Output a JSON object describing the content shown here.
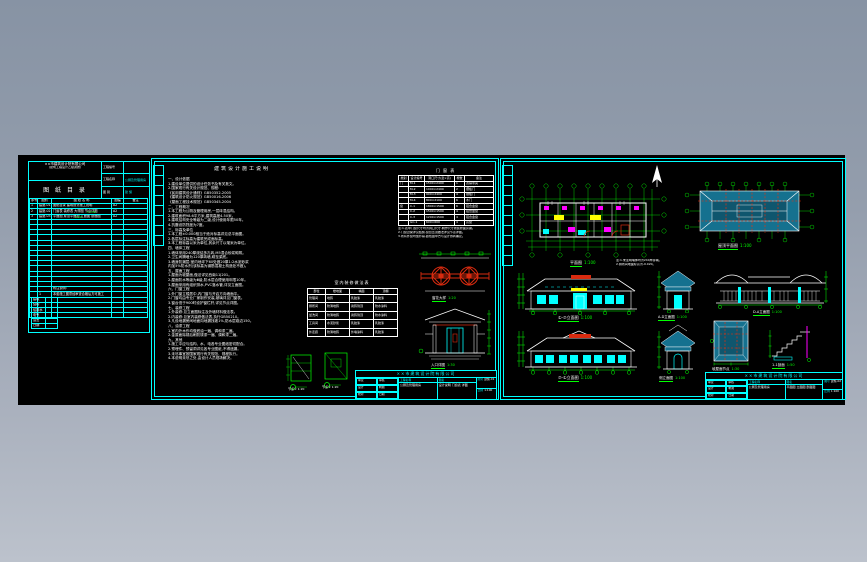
{
  "colors": {
    "cyan": "#00ffff",
    "green": "#00ff00",
    "white": "#ffffff",
    "red": "#d92b0f",
    "teal": "#15718f",
    "teal_dark": "#0f566e",
    "magenta": "#ff00ff",
    "yellow": "#ffff00",
    "canvas": "#000000"
  },
  "index_sheet": {
    "company_line1": "××市建筑设计院有限公司",
    "company_line2": "(建筑工程设计乙级资质)",
    "title": "图 纸 目 录",
    "fields": [
      [
        "工程编号",
        ""
      ],
      [
        "工程名称",
        "公厕及管理用房"
      ],
      [
        "图 别",
        "建 施"
      ]
    ],
    "columns": [
      "序号",
      "图别",
      "图 纸 名 称",
      "图幅",
      "备注"
    ],
    "rows": [
      [
        "1",
        "建施-01",
        "图纸目录 建筑设计施工说明",
        "A2",
        ""
      ],
      [
        "2",
        "建施-02",
        "门窗表 装修表 大样图 节点详图",
        "A2",
        ""
      ],
      [
        "3",
        "建施-03",
        "平面图 屋顶平面图 立面图 剖面图",
        "A2",
        ""
      ],
      [
        "",
        "",
        "",
        "",
        ""
      ],
      [
        "",
        "",
        "",
        "",
        ""
      ],
      [
        "",
        "",
        "",
        "",
        ""
      ],
      [
        "",
        "",
        "",
        "",
        ""
      ],
      [
        "",
        "",
        "",
        "",
        ""
      ],
      [
        "",
        "",
        "",
        "",
        ""
      ],
      [
        "",
        "",
        "",
        "",
        ""
      ],
      [
        "",
        "",
        "",
        "",
        ""
      ],
      [
        "",
        "",
        "",
        "",
        ""
      ],
      [
        "",
        "",
        "",
        "",
        ""
      ],
      [
        "",
        "",
        "",
        "",
        ""
      ],
      [
        "",
        "",
        "",
        "",
        ""
      ],
      [
        "",
        "",
        "",
        "",
        ""
      ],
      [
        "",
        "",
        "附注说明:",
        "",
        ""
      ],
      [
        "",
        "1",
        "本套施工图须经审查合格后方可施工",
        "",
        ""
      ],
      [
        "",
        "",
        "",
        "",
        ""
      ],
      [
        "",
        "",
        "",
        "",
        ""
      ],
      [
        "",
        "",
        "",
        "",
        ""
      ],
      [
        "",
        "",
        "",
        "",
        ""
      ]
    ],
    "green_marks": [
      "1:100",
      "1:20"
    ],
    "mini_rows": [
      [
        "建筑",
        ""
      ],
      [
        "结构",
        ""
      ],
      [
        "给排水",
        ""
      ],
      [
        "电气",
        ""
      ],
      [
        "会签",
        ""
      ],
      [
        "日期",
        ""
      ]
    ]
  },
  "notes_sheet": {
    "title": "建筑设计施工说明",
    "lines": [
      "一、设计依据",
      "1.建设单位提供的设计任务书及有关批文。",
      "2.国家现行有关设计规范、规程:",
      "《民用建筑设计通则》GB50352-2005",
      "《建筑设计防火规范》GB50016-2006",
      "《屋面工程技术规范》GB50345-2004",
      "二、工程概况",
      "1.本工程为公厕及管理用房,一层砖混结构。",
      "2.建筑面积98.6平方米,建筑高度4.50米。",
      "3.建筑结构安全等级为二级,设计使用年限50年。",
      "4.抗震设防烈度为7度。",
      "三、标高及单位",
      "1.本工程±0.000相当于绝对标高详见总平面图。",
      "2.各层标注标高为建筑完成面标高。",
      "3.本工程标高以米为单位,其余尺寸以毫米为单位。",
      "四、墙体工程",
      "1.墙体采用240厚烧结多孔砖,M5混合砂浆砌筑。",
      "2.卫生间隔墙为120厚砖墙,砌至梁底。",
      "3.墙身防潮层:室内地坪下60处做20厚1:2水泥砂浆",
      "内加5%防水剂(该标高为钢筋混凝土构造处不做)。",
      "五、屋面工程",
      "1.屋面为坡屋面,做法详见西南11J201。",
      "2.屋面防水等级为Ⅲ级,防水层合理使用年限10年。",
      "3.屋面采用有组织排水,PVC落水管,详见立面图。",
      "六、门窗工程",
      "1.外门窗立樘居中,内门窗与开启方向墙面平。",
      "2.门窗均由专业厂家制作安装,玻璃详见门窗表。",
      "3.窗台低于900时设护窗栏杆,详见节点详图。",
      "七、装修工程",
      "1.外装修:见立面图标注及外墙材料做法表。",
      "2.内装修:见室内装修做法表,执行GB50210。",
      "3.凡设地漏房间地面向地漏找坡1%,防水层卷边150。",
      "八、油漆工程",
      "1.室内外木作均做底油一遍、调和漆二遍。",
      "2.金属面除锈后刷防锈漆一遍、调和漆二遍。",
      "九、其他",
      "1.施工中应与结构、水、电各专业图纸密切配合。",
      "2.预埋件、预留洞详见各专业图纸,不得遗漏。",
      "3.未尽事宜按国家现行有关规范、规程执行。",
      "4.本说明未尽之处,由设计人员现场解决。"
    ],
    "window_table": {
      "title": "门 窗 表",
      "columns": [
        "类别",
        "设计编号",
        "洞口尺寸(宽×高)",
        "樘数",
        "备注"
      ],
      "rows": [
        [
          "门",
          "M-1",
          "1500×2400",
          "1",
          "双扇带亮"
        ],
        [
          "",
          "M-2",
          "1000×2400",
          "2",
          "镶板门"
        ],
        [
          "",
          "M-3",
          "900×2400",
          "4",
          "镶板门"
        ],
        [
          "",
          "M-4",
          "800×2100",
          "6",
          "木门"
        ],
        [
          "窗",
          "C-1",
          "1800×1500",
          "6",
          "铝合金窗"
        ],
        [
          "",
          "C-2",
          "1500×1500",
          "4",
          "铝合金窗"
        ],
        [
          "",
          "C-3",
          "1200×1500",
          "4",
          "铝合金窗"
        ],
        [
          "",
          "GC-1",
          "600×600",
          "4",
          "高窗"
        ]
      ],
      "notes": [
        "注:1.表中门窗尺寸均为洞口尺寸,制作尺寸按装修面另减。",
        "2.门窗过梁详见结施,窗台压顶做法详见节点详图。",
        "3.所有外窗均加纱扇,颜色由甲方与设计协商确定。"
      ]
    },
    "finish_table": {
      "title": "室内装修做法表",
      "columns": [
        "部位",
        "楼地面",
        "墙面",
        "顶棚"
      ],
      "rows": [
        [
          "管理间",
          "地砖",
          "乳胶漆",
          "乳胶漆"
        ],
        [
          "厕所间",
          "防滑地砖",
          "瓷砖到顶",
          "防水涂料"
        ],
        [
          "盥洗间",
          "防滑地砖",
          "瓷砖到顶",
          "防水涂料"
        ],
        [
          "工具间",
          "水泥砂浆",
          "乳胶漆",
          "乳胶漆"
        ],
        [
          "外走廊",
          "防滑地砖",
          "外墙涂料",
          "乳胶漆"
        ]
      ]
    },
    "ornament_caption": "窗花大样",
    "ornament_scale": "1:20",
    "entry_caption": "入口详图",
    "entry_scale": "1:30",
    "node_captions": [
      "节点① 1:20",
      "节点② 1:20"
    ],
    "titleblock": {
      "company": "××市建筑设计院有限公司",
      "labels": [
        "审定",
        "审核",
        "设计",
        "制图",
        "校对",
        "日期"
      ],
      "project_label": "工程名称",
      "project": "公厕及管理用房",
      "drawing_label": "图名",
      "drawing": "设计说明 门窗表 详图",
      "no_label": "图号",
      "no": "建施-01",
      "scale_label": "比例",
      "scale": "1:100"
    }
  },
  "plan_sheet": {
    "plan_caption": "平面图",
    "plan_scale": "1:100",
    "plan_notes": [
      "注:1.未注明墙体均为240厚砖墙。",
      "2.厕所间地面标高为-0.020。"
    ],
    "roof_caption": "屋顶平面图",
    "roof_scale": "1:100",
    "elev1_caption": "①-⑦立面图",
    "elev1_scale": "1:100",
    "elev2_caption": "⑦-①立面图",
    "elev2_scale": "1:100",
    "side1_caption": "A-D立面图",
    "side1_scale": "1:100",
    "veranda_caption": "D-A立面图",
    "veranda_scale": "1:100",
    "side2_caption": "侧立面图",
    "side2_scale": "1:100",
    "roofdetail_caption": "坡屋面节点",
    "roofdetail_scale": "1:30",
    "stair_caption": "1-1剖面",
    "stair_scale": "1:50",
    "titleblock": {
      "company": "××市建筑设计院有限公司",
      "labels": [
        "审定",
        "审核",
        "设计",
        "制图",
        "校对",
        "日期"
      ],
      "project_label": "工程名称",
      "project": "公厕及管理用房",
      "drawing_label": "图名",
      "drawing": "平面图 立面图 剖面图",
      "no_label": "图号",
      "no": "建施-02",
      "scale_label": "比例",
      "scale": "1:100"
    }
  }
}
